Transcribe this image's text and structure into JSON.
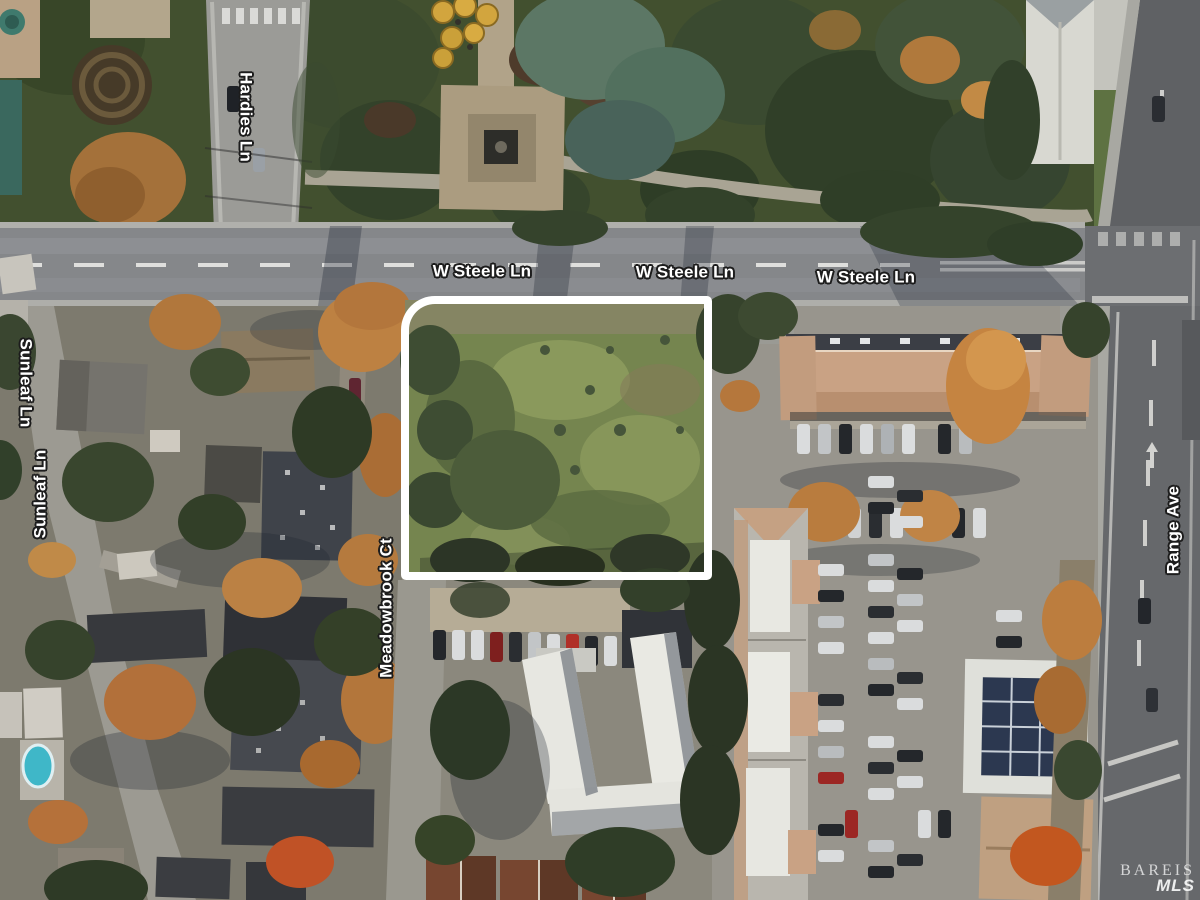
{
  "street_labels": {
    "hardies": "Hardies Ln",
    "w_steele_1": "W Steele Ln",
    "w_steele_2": "W Steele Ln",
    "w_steele_3": "W Steele Ln",
    "sunleaf_1": "Sunleaf Ln",
    "sunleaf_2": "Sunleaf Ln",
    "meadowbrook": "Meadowbrook Ct",
    "range": "Range Ave"
  },
  "watermark": {
    "brand": "BAREIS",
    "sub": "MLS"
  },
  "colors": {
    "label_text": "#ffffff",
    "label_halo": "#1d1d1d",
    "parcel_outline": "#ffffff",
    "road_asphalt": "#87898c",
    "range_asphalt": "#66686b",
    "parcel_grass": "#75854f",
    "tree_green": "#3a4a30",
    "tree_conifer_teal": "#5c7765",
    "tree_autumn": "#c08140",
    "strip_mall_roof": "#c9a284",
    "apartment_roof_white": "#e7e7e1",
    "pool_blue": "#3fb7c8"
  }
}
